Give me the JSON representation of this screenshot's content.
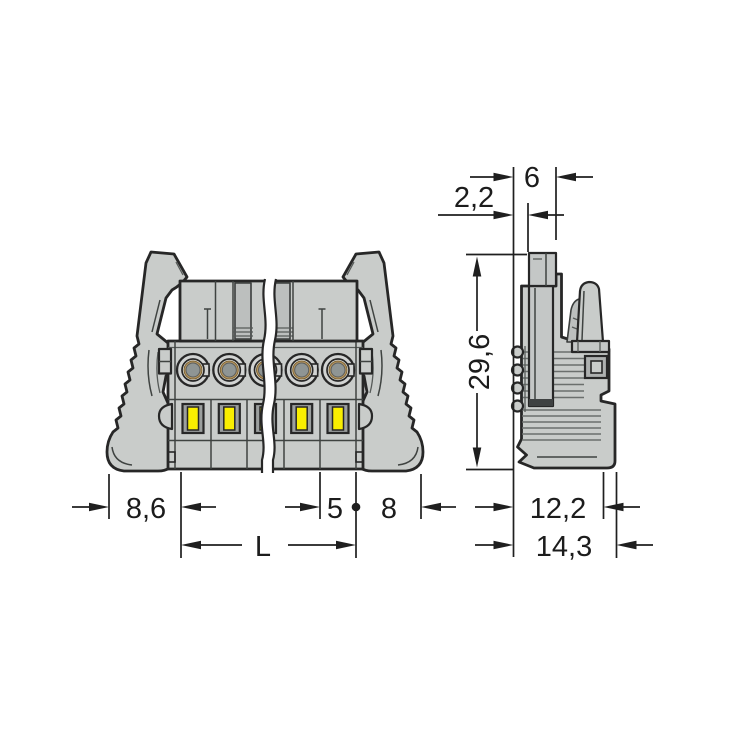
{
  "drawing": {
    "kind": "connector-dimensional-drawing",
    "front_view": {
      "poles_visible": 5,
      "dim_left_lever_offset": "8,6",
      "dim_pole_pitch": "5",
      "dim_right_lever_offset": "8",
      "dim_total_length": "L"
    },
    "side_view": {
      "dim_top_inset": "2,2",
      "dim_top_width": "6",
      "dim_height": "29,6",
      "dim_depth_inner": "12,2",
      "dim_depth_total": "14,3"
    },
    "colors": {
      "background": "#ffffff",
      "body_gray": "#c9ccca",
      "recess_gray": "#bcbfbe",
      "outline_dark": "#272727",
      "window_yellow": "#f9ee00",
      "contact_tan": "#b6955f",
      "contact_inner_gray": "#8f9594",
      "dimension_ink": "#1c1c1c"
    }
  }
}
